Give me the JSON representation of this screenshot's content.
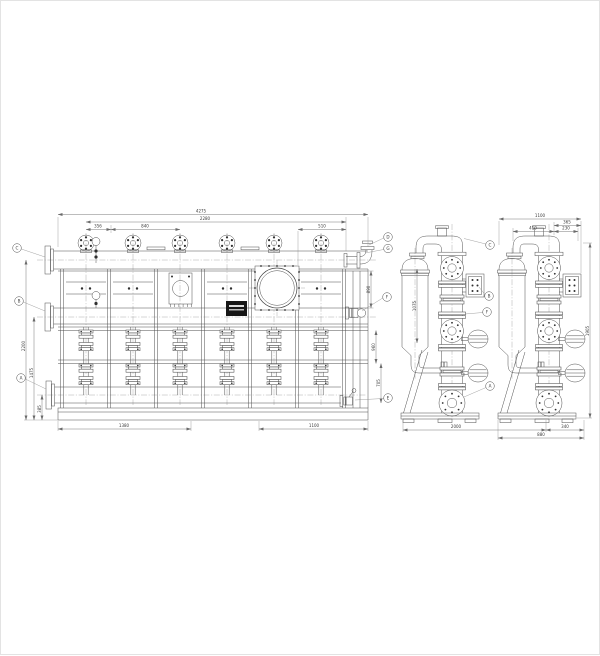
{
  "sheet": {
    "bg": "#ffffff",
    "border": "#e3e3e3",
    "line_color": "#4f4f4f",
    "dim_color": "#6a6a6a"
  },
  "front_view": {
    "dims_top": {
      "overall": "4275",
      "span": "2280",
      "seg1": "356",
      "seg2": "840",
      "seg3": "510"
    },
    "dims_left": {
      "overall": "2200",
      "mid": "1475",
      "lower": "385"
    },
    "dims_right": {
      "upper": "890",
      "mid": "960",
      "lower": "705"
    },
    "dims_bottom": {
      "left": "1380",
      "right": "1100"
    },
    "balloons": {
      "c": "C",
      "b": "B",
      "a": "A",
      "d": "D",
      "g": "G",
      "f": "F",
      "e": "E"
    }
  },
  "side_view_left": {
    "dims": {
      "vessel_height": "1075"
    },
    "balloons": {
      "c": "C",
      "b": "B",
      "f": "F",
      "a": "A"
    }
  },
  "side_view_right": {
    "dims_top": {
      "overall": "1100",
      "right": "365",
      "left": "410",
      "small": "230"
    },
    "dims_right": {
      "height": "1905"
    },
    "dims_bottom": {
      "pitch": "2000",
      "offset": "340",
      "width": "880"
    }
  }
}
